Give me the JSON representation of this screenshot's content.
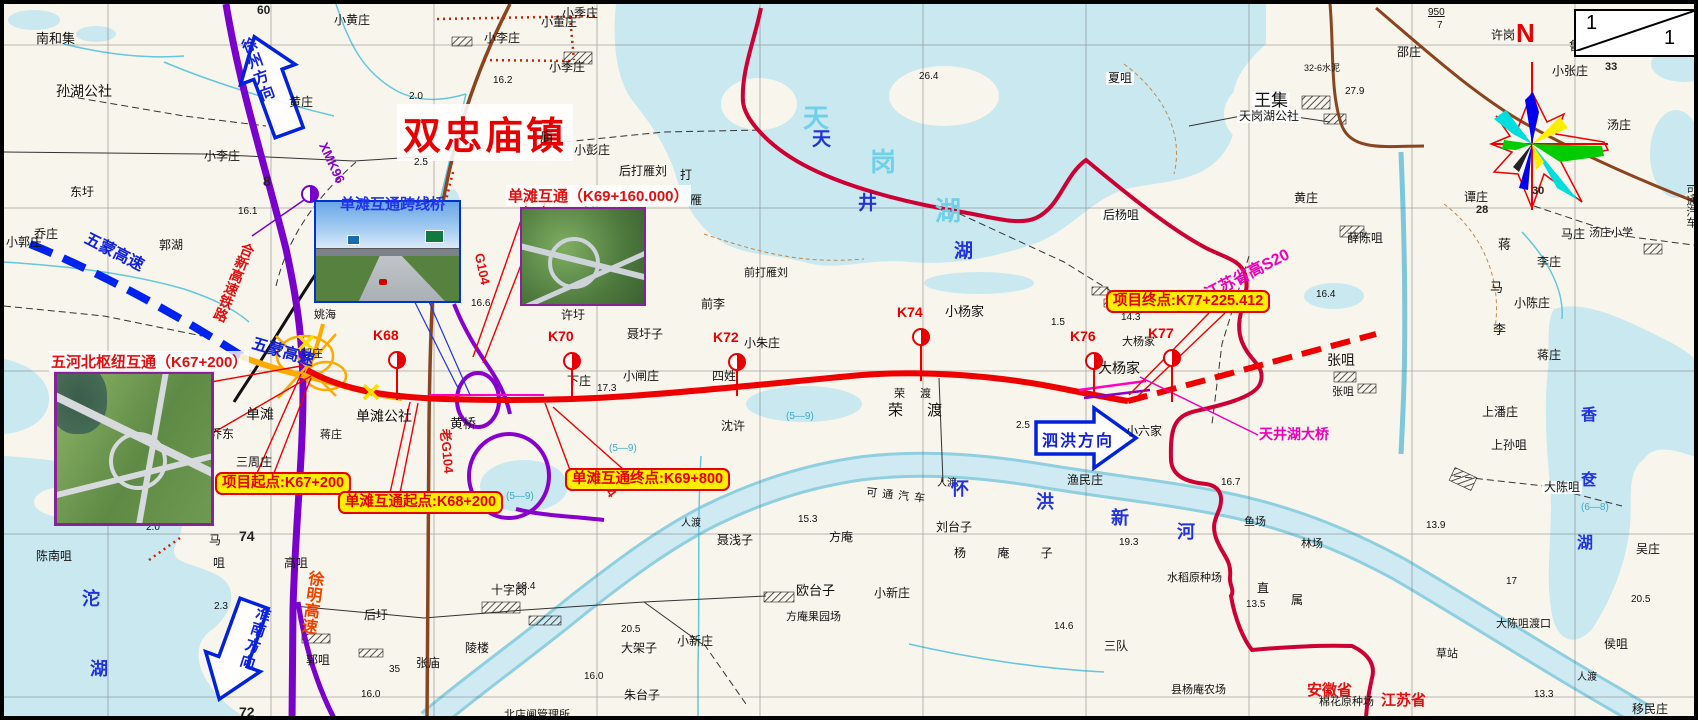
{
  "page": {
    "town_title": "双忠庙镇",
    "compass_north": "N",
    "scale_corner": {
      "top": "1",
      "bottom": "1"
    }
  },
  "boxes": [
    {
      "text": "项目起点:K67+200"
    },
    {
      "text": "单滩互通起点:K68+200"
    },
    {
      "text": "单滩互通终点:K69+800"
    },
    {
      "text": "项目终点:K77+225.412"
    }
  ],
  "photos": [
    {
      "label": "单滩互通跨线桥"
    },
    {
      "label": "单滩互通（K69+160.000）"
    },
    {
      "label": "五河北枢纽互通（K67+200）"
    }
  ],
  "arrows": {
    "xuzhou": {
      "label": "徐州方向"
    },
    "sihong": {
      "label": "泗洪方向"
    },
    "huainan": {
      "label": "淮南方向"
    }
  },
  "stations": [
    {
      "label": "K68",
      "x": 393,
      "y": 356,
      "stem": 32
    },
    {
      "label": "K70",
      "x": 568,
      "y": 357,
      "stem": 32
    },
    {
      "label": "K72",
      "x": 733,
      "y": 358,
      "stem": 26
    },
    {
      "label": "K74",
      "x": 917,
      "y": 333,
      "stem": 36
    },
    {
      "label": "K76",
      "x": 1090,
      "y": 357,
      "stem": 28
    },
    {
      "label": "K77",
      "x": 1168,
      "y": 354,
      "stem": 36
    }
  ],
  "labels": [
    {
      "t": "南和集",
      "x": 32,
      "y": 28,
      "fs": 13
    },
    {
      "t": "孙湖公社",
      "x": 52,
      "y": 80,
      "fs": 14
    },
    {
      "t": "东圩",
      "x": 66,
      "y": 182
    },
    {
      "t": "乔庄",
      "x": 30,
      "y": 224
    },
    {
      "t": "小郭庄",
      "x": 2,
      "y": 232
    },
    {
      "t": "郭湖",
      "x": 155,
      "y": 235
    },
    {
      "t": "小李庄",
      "x": 200,
      "y": 146
    },
    {
      "t": "小李庄",
      "x": 480,
      "y": 28
    },
    {
      "t": "小季庄",
      "x": 545,
      "y": 57
    },
    {
      "t": "小季庄",
      "x": 558,
      "y": 3
    },
    {
      "t": "小黄庄",
      "x": 330,
      "y": 10
    },
    {
      "t": "小董庄",
      "x": 537,
      "y": 12
    },
    {
      "t": "黄庄",
      "x": 285,
      "y": 92
    },
    {
      "t": "小彭庄",
      "x": 570,
      "y": 140
    },
    {
      "t": "庙",
      "x": 536,
      "y": 126,
      "fs": 13
    },
    {
      "t": "后打雁刘",
      "x": 615,
      "y": 161
    },
    {
      "t": "打",
      "x": 676,
      "y": 165
    },
    {
      "t": "雁",
      "x": 686,
      "y": 190
    },
    {
      "t": "刘家",
      "x": 577,
      "y": 202,
      "v": 1
    },
    {
      "t": "前打雁刘",
      "x": 740,
      "y": 264,
      "fs": 11
    },
    {
      "t": "小朱庄",
      "x": 740,
      "y": 333
    },
    {
      "t": "单滩",
      "x": 242,
      "y": 403,
      "fs": 14
    },
    {
      "t": "单滩公社",
      "x": 352,
      "y": 405,
      "fs": 14
    },
    {
      "t": "黄桥",
      "x": 446,
      "y": 413,
      "fs": 13
    },
    {
      "t": "乔东",
      "x": 206,
      "y": 424
    },
    {
      "t": "三周庄",
      "x": 232,
      "y": 452
    },
    {
      "t": "郭庄",
      "x": 297,
      "y": 345,
      "fs": 11
    },
    {
      "t": "姚海",
      "x": 310,
      "y": 306,
      "fs": 11
    },
    {
      "t": "蒋庄",
      "x": 316,
      "y": 426,
      "fs": 11
    },
    {
      "t": "下庄",
      "x": 563,
      "y": 371
    },
    {
      "t": "小闸庄",
      "x": 619,
      "y": 366
    },
    {
      "t": "聂圩子",
      "x": 623,
      "y": 324
    },
    {
      "t": "四姓",
      "x": 708,
      "y": 366
    },
    {
      "t": "前李",
      "x": 697,
      "y": 294
    },
    {
      "t": "许圩",
      "x": 557,
      "y": 305
    },
    {
      "t": "沈许",
      "x": 717,
      "y": 416
    },
    {
      "t": "荣 渡",
      "x": 890,
      "y": 385,
      "fs": 11,
      "ls": 6
    },
    {
      "t": "荣 渡",
      "x": 884,
      "y": 399,
      "fs": 15,
      "ls": 10
    },
    {
      "t": "小杨家",
      "x": 941,
      "y": 301,
      "fs": 13
    },
    {
      "t": "大杨家",
      "x": 1118,
      "y": 333,
      "fs": 11
    },
    {
      "t": "大杨家",
      "x": 1094,
      "y": 357,
      "fs": 14
    },
    {
      "t": "张咀",
      "x": 1323,
      "y": 349,
      "fs": 14
    },
    {
      "t": "张咀",
      "x": 1328,
      "y": 383,
      "fs": 11
    },
    {
      "t": "王集",
      "x": 1248,
      "y": 88,
      "fs": 17,
      "bg": 1
    },
    {
      "t": "天岗湖公社",
      "x": 1233,
      "y": 106,
      "bg": 1
    },
    {
      "t": "夏咀",
      "x": 1102,
      "y": 68,
      "bg": 1
    },
    {
      "t": "后杨咀",
      "x": 1097,
      "y": 205,
      "bg": 1
    },
    {
      "t": "黄庄",
      "x": 1290,
      "y": 188
    },
    {
      "t": "薛陈咀",
      "x": 1343,
      "y": 228
    },
    {
      "t": "邵庄",
      "x": 1393,
      "y": 42
    },
    {
      "t": "许岗",
      "x": 1487,
      "y": 25
    },
    {
      "t": "鲁庄",
      "x": 1565,
      "y": 36
    },
    {
      "t": "小张庄",
      "x": 1548,
      "y": 61
    },
    {
      "t": "汤庄",
      "x": 1603,
      "y": 115
    },
    {
      "t": "谭庄",
      "x": 1460,
      "y": 187
    },
    {
      "t": "马庄",
      "x": 1557,
      "y": 224
    },
    {
      "t": "汤庄小学",
      "x": 1585,
      "y": 224,
      "fs": 11
    },
    {
      "t": "蒋",
      "x": 1494,
      "y": 234,
      "fs": 13
    },
    {
      "t": "李庄",
      "x": 1533,
      "y": 252
    },
    {
      "t": "马",
      "x": 1486,
      "y": 277,
      "fs": 13
    },
    {
      "t": "小陈庄",
      "x": 1510,
      "y": 293
    },
    {
      "t": "李",
      "x": 1489,
      "y": 319,
      "fs": 13
    },
    {
      "t": "蒋庄",
      "x": 1533,
      "y": 345
    },
    {
      "t": "上潘庄",
      "x": 1478,
      "y": 402
    },
    {
      "t": "上孙咀",
      "x": 1487,
      "y": 435
    },
    {
      "t": "大陈咀",
      "x": 1538,
      "y": 477,
      "bg": 1
    },
    {
      "t": "吴庄",
      "x": 1632,
      "y": 539
    },
    {
      "t": "侯咀",
      "x": 1600,
      "y": 634
    },
    {
      "t": "大陈咀渡口",
      "x": 1492,
      "y": 615,
      "fs": 11
    },
    {
      "t": "草站",
      "x": 1432,
      "y": 645,
      "fs": 11
    },
    {
      "t": "移民庄",
      "x": 1628,
      "y": 699
    },
    {
      "t": "林场",
      "x": 1297,
      "y": 535,
      "fs": 11
    },
    {
      "t": "鱼场",
      "x": 1240,
      "y": 513,
      "fs": 11
    },
    {
      "t": "渔民庄",
      "x": 1063,
      "y": 470
    },
    {
      "t": "小六家",
      "x": 1122,
      "y": 421
    },
    {
      "t": "刘台子",
      "x": 932,
      "y": 517
    },
    {
      "t": "杨 庵 子",
      "x": 950,
      "y": 543,
      "ls": 14
    },
    {
      "t": "水稻原种场",
      "x": 1163,
      "y": 569,
      "fs": 11
    },
    {
      "t": "直",
      "x": 1253,
      "y": 578
    },
    {
      "t": "属",
      "x": 1287,
      "y": 590
    },
    {
      "t": "三队",
      "x": 1100,
      "y": 636
    },
    {
      "t": "县杨庵农场",
      "x": 1167,
      "y": 681,
      "fs": 11
    },
    {
      "t": "棉花原种场",
      "x": 1315,
      "y": 693,
      "fs": 11
    },
    {
      "t": "陈南咀",
      "x": 32,
      "y": 546
    },
    {
      "t": "马",
      "x": 205,
      "y": 530
    },
    {
      "t": "咀",
      "x": 209,
      "y": 553
    },
    {
      "t": "高咀",
      "x": 280,
      "y": 553
    },
    {
      "t": "郭咀",
      "x": 302,
      "y": 650
    },
    {
      "t": "后圩",
      "x": 360,
      "y": 605
    },
    {
      "t": "张庙",
      "x": 412,
      "y": 653
    },
    {
      "t": "陵楼",
      "x": 461,
      "y": 638
    },
    {
      "t": "十字岗",
      "x": 487,
      "y": 580
    },
    {
      "t": "大架子",
      "x": 617,
      "y": 638
    },
    {
      "t": "朱台子",
      "x": 620,
      "y": 685
    },
    {
      "t": "北店闸管理所",
      "x": 500,
      "y": 706,
      "fs": 11
    },
    {
      "t": "小新庄",
      "x": 673,
      "y": 631
    },
    {
      "t": "小新庄",
      "x": 870,
      "y": 583
    },
    {
      "t": "欧台子",
      "x": 792,
      "y": 580,
      "fs": 13
    },
    {
      "t": "方庵",
      "x": 825,
      "y": 527
    },
    {
      "t": "方庵果园场",
      "x": 782,
      "y": 608,
      "fs": 11
    },
    {
      "t": "聂浅子",
      "x": 713,
      "y": 530
    },
    {
      "t": "人渡",
      "x": 677,
      "y": 515,
      "fs": 10
    },
    {
      "t": "人渡",
      "x": 933,
      "y": 475,
      "fs": 10
    },
    {
      "t": "人渡",
      "x": 1573,
      "y": 669,
      "fs": 10
    },
    {
      "t": "可通汽车",
      "x": 862,
      "y": 487,
      "fs": 11,
      "ls": 5,
      "r": 6
    },
    {
      "t": "可通汽车",
      "x": 1680,
      "y": 180,
      "fs": 11,
      "v": 1
    },
    {
      "t": "16.2",
      "x": 489,
      "y": 72,
      "fs": 10,
      "c": "n"
    },
    {
      "t": "2.5",
      "x": 410,
      "y": 154,
      "fs": 10,
      "c": "n"
    },
    {
      "t": "16.1",
      "x": 234,
      "y": 203,
      "fs": 10,
      "c": "n"
    },
    {
      "t": "17.3",
      "x": 593,
      "y": 380,
      "fs": 10,
      "c": "n"
    },
    {
      "t": "16.4",
      "x": 1312,
      "y": 286,
      "fs": 10,
      "c": "n"
    },
    {
      "t": "14.3",
      "x": 1117,
      "y": 309,
      "fs": 10,
      "c": "n"
    },
    {
      "t": "26.4",
      "x": 915,
      "y": 68,
      "fs": 10,
      "c": "n"
    },
    {
      "t": "16.7",
      "x": 1217,
      "y": 474,
      "fs": 10,
      "c": "n"
    },
    {
      "t": "19.3",
      "x": 1115,
      "y": 534,
      "fs": 10,
      "c": "n"
    },
    {
      "t": "13.5",
      "x": 1242,
      "y": 596,
      "fs": 10,
      "c": "n"
    },
    {
      "t": "14.6",
      "x": 1050,
      "y": 618,
      "fs": 10,
      "c": "n"
    },
    {
      "t": "13.9",
      "x": 1422,
      "y": 517,
      "fs": 10,
      "c": "n"
    },
    {
      "t": "20.5",
      "x": 1627,
      "y": 591,
      "fs": 10,
      "c": "n"
    },
    {
      "t": "20.5",
      "x": 617,
      "y": 621,
      "fs": 10,
      "c": "n"
    },
    {
      "t": "18.4",
      "x": 512,
      "y": 578,
      "fs": 10,
      "c": "n"
    },
    {
      "t": "16.0",
      "x": 357,
      "y": 686,
      "fs": 10,
      "c": "n"
    },
    {
      "t": "16.0",
      "x": 580,
      "y": 668,
      "fs": 10,
      "c": "n"
    },
    {
      "t": "15.3",
      "x": 794,
      "y": 511,
      "fs": 10,
      "c": "n"
    },
    {
      "t": "13.3",
      "x": 1530,
      "y": 686,
      "fs": 10,
      "c": "n"
    },
    {
      "t": "27.9",
      "x": 1341,
      "y": 83,
      "fs": 10,
      "c": "n"
    },
    {
      "t": "35",
      "x": 385,
      "y": 661,
      "fs": 10,
      "c": "n"
    },
    {
      "t": "16.6",
      "x": 467,
      "y": 295,
      "fs": 10,
      "c": "n"
    },
    {
      "t": "2.0",
      "x": 405,
      "y": 88,
      "fs": 10,
      "c": "n"
    },
    {
      "t": "2.3",
      "x": 210,
      "y": 598,
      "fs": 10,
      "c": "n"
    },
    {
      "t": "2.0",
      "x": 142,
      "y": 519,
      "fs": 10,
      "c": "n"
    },
    {
      "t": "2.5",
      "x": 1012,
      "y": 417,
      "fs": 10,
      "c": "n"
    },
    {
      "t": "1.5",
      "x": 1047,
      "y": 314,
      "fs": 10,
      "c": "n"
    },
    {
      "t": "17",
      "x": 1502,
      "y": 573,
      "fs": 10,
      "c": "n"
    },
    {
      "t": "950",
      "x": 1424,
      "y": 4,
      "fs": 10,
      "c": "n",
      "u": 1
    },
    {
      "t": "7",
      "x": 1433,
      "y": 17,
      "fs": 10,
      "c": "n"
    },
    {
      "t": "60",
      "x": 253,
      "y": 0,
      "fs": 12,
      "c": "gn"
    },
    {
      "t": "8",
      "x": 259,
      "y": 170,
      "fs": 14,
      "c": "gn"
    },
    {
      "t": "74",
      "x": 235,
      "y": 525,
      "fs": 14,
      "c": "gn"
    },
    {
      "t": "72",
      "x": 235,
      "y": 701,
      "fs": 14,
      "c": "gn"
    },
    {
      "t": "33",
      "x": 1601,
      "y": 58,
      "fs": 11,
      "c": "gn"
    },
    {
      "t": "30",
      "x": 1528,
      "y": 182,
      "fs": 11,
      "c": "gn"
    },
    {
      "t": "28",
      "x": 1472,
      "y": 201,
      "fs": 11,
      "c": "gn"
    },
    {
      "t": "(5—9)",
      "x": 502,
      "y": 488,
      "fs": 10,
      "c": "cy2"
    },
    {
      "t": "(5—9)",
      "x": 782,
      "y": 408,
      "fs": 10,
      "c": "cy2"
    },
    {
      "t": "(5—9)",
      "x": 605,
      "y": 440,
      "fs": 10,
      "c": "cy2"
    },
    {
      "t": "(6—8)",
      "x": 1577,
      "y": 499,
      "fs": 10,
      "c": "cy2"
    },
    {
      "t": "32-6水泥",
      "x": 1300,
      "y": 60,
      "fs": 9,
      "c": "n"
    },
    {
      "t": "天",
      "x": 799,
      "y": 100,
      "fs": 26,
      "c": "cyL"
    },
    {
      "t": "岗",
      "x": 866,
      "y": 144,
      "fs": 26,
      "c": "cyL"
    },
    {
      "t": "湖",
      "x": 931,
      "y": 193,
      "fs": 26,
      "c": "cyL"
    },
    {
      "t": "天",
      "x": 808,
      "y": 126,
      "fs": 19,
      "c": "wb"
    },
    {
      "t": "井",
      "x": 854,
      "y": 190,
      "fs": 19,
      "c": "wb"
    },
    {
      "t": "湖",
      "x": 950,
      "y": 238,
      "fs": 19,
      "c": "wb"
    },
    {
      "t": "沱",
      "x": 78,
      "y": 586,
      "fs": 18,
      "c": "wb"
    },
    {
      "t": "湖",
      "x": 86,
      "y": 656,
      "fs": 18,
      "c": "wb"
    },
    {
      "t": "香",
      "x": 1577,
      "y": 403,
      "fs": 16,
      "c": "wb"
    },
    {
      "t": "奁",
      "x": 1577,
      "y": 468,
      "fs": 16,
      "c": "wb"
    },
    {
      "t": "湖",
      "x": 1573,
      "y": 531,
      "fs": 16,
      "c": "wb"
    },
    {
      "t": "怀",
      "x": 947,
      "y": 476,
      "fs": 18,
      "c": "wb"
    },
    {
      "t": "洪",
      "x": 1032,
      "y": 489,
      "fs": 18,
      "c": "wb"
    },
    {
      "t": "新",
      "x": 1107,
      "y": 505,
      "fs": 18,
      "c": "wb"
    },
    {
      "t": "河",
      "x": 1173,
      "y": 519,
      "fs": 18,
      "c": "wb"
    },
    {
      "t": "五蒙高速",
      "x": 78,
      "y": 240,
      "fs": 16,
      "c": "bl",
      "r": 27,
      "n": "road-label-wumeng-expressway"
    },
    {
      "t": "五蒙高速",
      "x": 247,
      "y": 340,
      "fs": 16,
      "c": "bl",
      "r": 16,
      "n": "road-label-wumeng-expressway"
    },
    {
      "t": "合新高速铁路",
      "x": 222,
      "y": 236,
      "fs": 14,
      "c": "rd",
      "v": 1,
      "r": 22,
      "n": "road-label-hexin-hsr"
    },
    {
      "t": "徐明高速",
      "x": 298,
      "y": 566,
      "fs": 16,
      "c": "or",
      "v": 1,
      "r": 8,
      "n": "road-label-xuming-expressway"
    },
    {
      "t": "XMK96",
      "x": 306,
      "y": 152,
      "fs": 13,
      "c": "pu",
      "r": 65,
      "n": "road-label-xmk96"
    },
    {
      "t": "G104",
      "x": 462,
      "y": 258,
      "fs": 13,
      "c": "rd",
      "r": 78,
      "n": "road-label-g104"
    },
    {
      "t": "老G104",
      "x": 420,
      "y": 440,
      "fs": 13,
      "c": "rd",
      "r": 85,
      "n": "road-label-old-g104"
    },
    {
      "t": "G104",
      "x": 584,
      "y": 472,
      "fs": 13,
      "c": "rd",
      "r": 55,
      "n": "road-label-g104"
    },
    {
      "t": "接江苏省高S20",
      "x": 1182,
      "y": 266,
      "fs": 16,
      "c": "mg",
      "r": -27,
      "n": "road-label-jiangsu-s20"
    },
    {
      "t": "天井湖大桥",
      "x": 1255,
      "y": 423,
      "fs": 14,
      "c": "mg",
      "n": "bridge-label-tianjinghu"
    },
    {
      "t": "安徽省",
      "x": 1303,
      "y": 679,
      "fs": 15,
      "c": "prov",
      "n": "province-label-anhui"
    },
    {
      "t": "江苏省",
      "x": 1377,
      "y": 689,
      "fs": 15,
      "c": "prov",
      "n": "province-label-jiangsu"
    }
  ]
}
